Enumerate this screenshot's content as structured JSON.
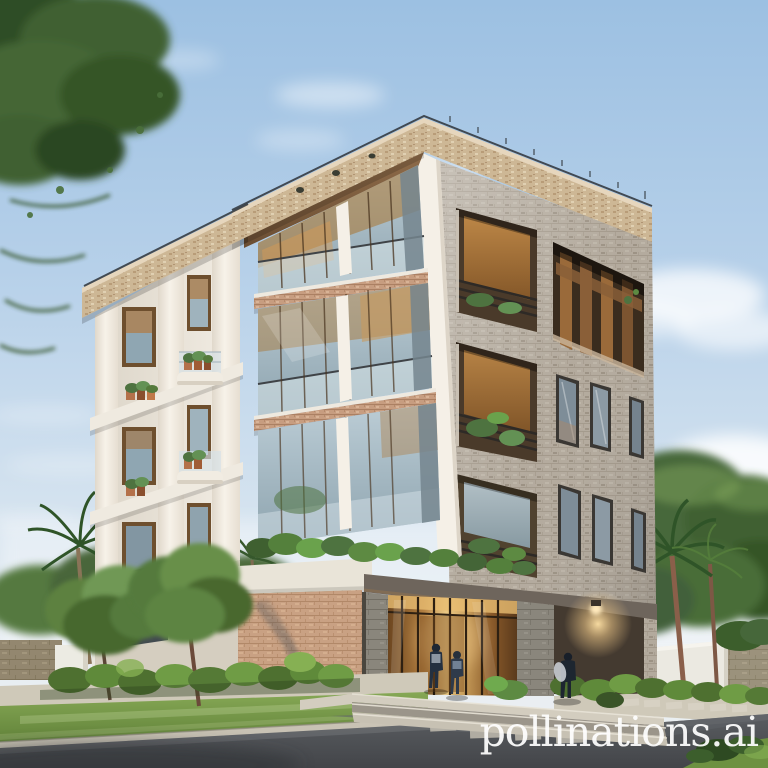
{
  "watermark": {
    "text": "pollinations.ai",
    "color": "#ffffff",
    "opacity": 0.93
  },
  "palette": {
    "sky_top": "#9cc0e2",
    "sky_horizon": "#edf0f1",
    "facade_white": "#f0ebe1",
    "facade_shade": "#d9d2c6",
    "fascia_warm": "#cdb795",
    "soffit_brown": "#8a6847",
    "brick_gray": "#b3aa9d",
    "brick_warm": "#c9a183",
    "balcony_terracotta": "#c79d80",
    "glass_blue": "#9fb4bf",
    "glass_amber": "#b07a3e",
    "entrance_glow": "#ffd998",
    "canopy_stone": "#6e655c",
    "foliage_dark": "#3c5c2e",
    "foliage_light": "#79a251",
    "grass": "#74994a",
    "hedge": "#587a36",
    "road_asphalt": "#4e5156",
    "sidewalk": "#cfc9b9",
    "boundary_wall_white": "#ebe9e1",
    "boundary_wall_stone": "#93876f",
    "trunk": "#8a5f4a",
    "railing": "#3f4347",
    "people_silhouette": "#243040"
  }
}
